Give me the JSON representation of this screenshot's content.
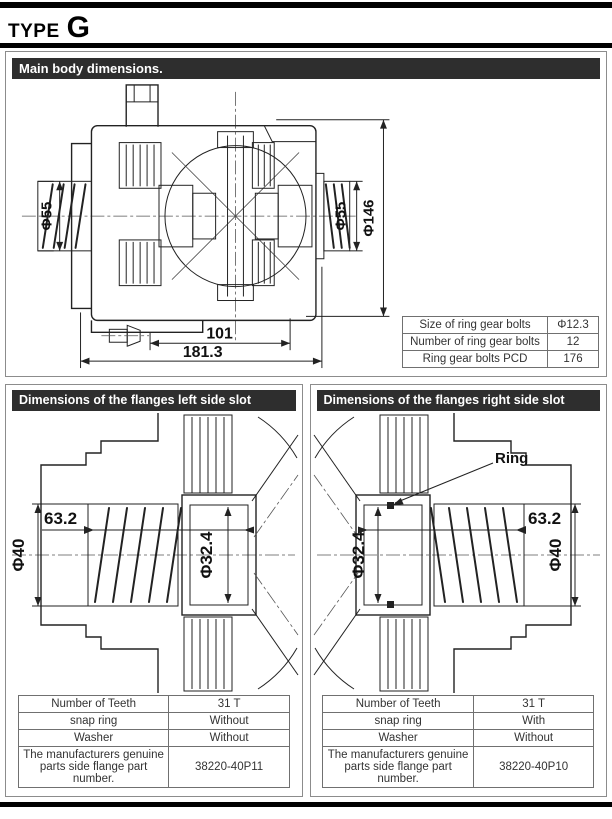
{
  "page": {
    "type_label": "TYPE",
    "type_value": "G"
  },
  "colors": {
    "header_bar_bg": "#2e2e2e",
    "header_bar_text": "#ffffff",
    "section_border": "#8c8c8c",
    "table_border": "#707070",
    "drawing_line": "#222222",
    "dim_text": "#111111"
  },
  "main_section": {
    "header": "Main body dimensions.",
    "drawing": {
      "dim_left_dia": "Φ55",
      "dim_right_dia": "Φ55",
      "dim_outer_dia": "Φ146",
      "dim_inner_length": "101",
      "dim_overall_length": "181.3"
    },
    "table": {
      "rows": [
        {
          "label": "Size of ring gear bolts",
          "value": "Φ12.3"
        },
        {
          "label": "Number of ring gear bolts",
          "value": "12"
        },
        {
          "label": "Ring gear bolts PCD",
          "value": "176"
        }
      ]
    }
  },
  "left_flange_section": {
    "header": "Dimensions of the flanges left side slot",
    "drawing": {
      "dim_slot_depth": "63.2",
      "dim_shaft_dia": "Φ40",
      "dim_slot_dia": "Φ32.4"
    },
    "table": {
      "rows": [
        {
          "label": "Number of Teeth",
          "value": "31 T"
        },
        {
          "label": "snap ring",
          "value": "Without"
        },
        {
          "label": "Washer",
          "value": "Without"
        },
        {
          "label": "The manufacturers genuine parts side flange part number.",
          "value": "38220-40P11"
        }
      ]
    }
  },
  "right_flange_section": {
    "header": "Dimensions of the flanges right side slot",
    "drawing": {
      "ring_label": "Ring",
      "dim_slot_depth": "63.2",
      "dim_shaft_dia": "Φ40",
      "dim_slot_dia": "Φ32.4"
    },
    "table": {
      "rows": [
        {
          "label": "Number of Teeth",
          "value": "31 T"
        },
        {
          "label": "snap ring",
          "value": "With"
        },
        {
          "label": "Washer",
          "value": "Without"
        },
        {
          "label": "The manufacturers genuine parts side flange part number.",
          "value": "38220-40P10"
        }
      ]
    }
  }
}
